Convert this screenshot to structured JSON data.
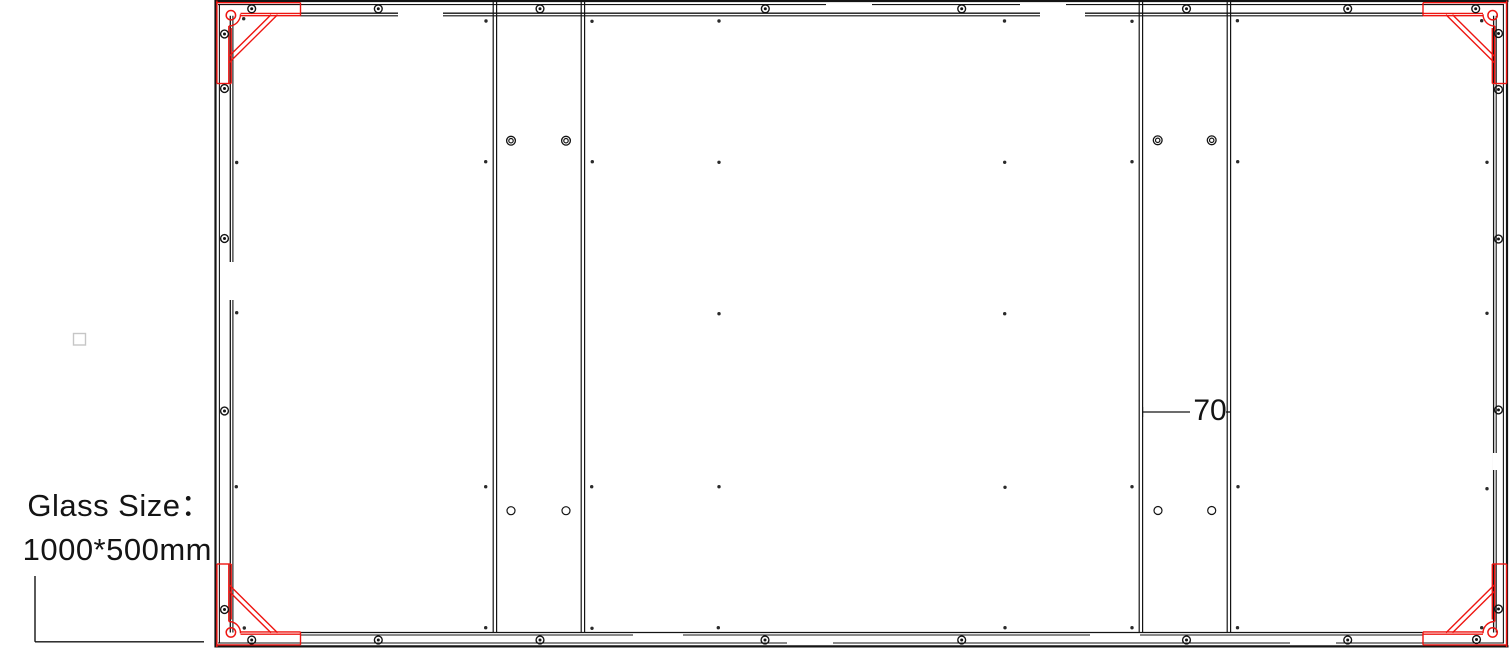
{
  "labels": {
    "glass_size_line1": "Glass Size：",
    "glass_size_line2": "1000*500mm",
    "bar_width_dimension": "70"
  },
  "colors": {
    "line": "#141414",
    "red": "#ee1511",
    "faint": "#c6c6c6",
    "background": "#ffffff"
  },
  "drawing": {
    "width": 1509,
    "height": 648,
    "black_lines": [
      [
        214.5,
        1,
        1508.5,
        1,
        2.2
      ],
      [
        218,
        4.6,
        1504,
        4.6,
        1.1
      ],
      [
        214.5,
        646.4,
        1508.5,
        646.4,
        2.2
      ],
      [
        218,
        643,
        1504,
        643,
        1.1
      ],
      [
        215.5,
        0,
        215.5,
        647.5,
        2.2
      ],
      [
        219.4,
        4,
        219.4,
        643.5,
        1.1
      ],
      [
        1507,
        0,
        1507,
        647.5,
        2.2
      ],
      [
        1503.4,
        4,
        1503.4,
        643.5,
        1.1
      ],
      [
        300.5,
        13.2,
        1423,
        13.2,
        1.3
      ],
      [
        300.5,
        15.8,
        1423,
        15.8,
        1.1
      ],
      [
        300.5,
        632.5,
        1423,
        632.5,
        1.3
      ],
      [
        300.5,
        635,
        1423,
        635,
        1.1
      ],
      [
        230.3,
        15.8,
        230.3,
        632.5,
        1.3
      ],
      [
        232.9,
        15.8,
        232.9,
        632.5,
        1.1
      ],
      [
        1493.6,
        15.8,
        1493.6,
        632.5,
        1.3
      ],
      [
        1496.2,
        15.8,
        1496.2,
        632.5,
        1.1
      ],
      [
        493.2,
        1,
        493.2,
        632.5,
        1.2
      ],
      [
        496.6,
        1,
        496.6,
        632.5,
        1.2
      ],
      [
        581.2,
        1,
        581.2,
        632.5,
        1.2
      ],
      [
        584.6,
        1,
        584.6,
        632.5,
        1.2
      ],
      [
        1139.2,
        1,
        1139.2,
        632.5,
        1.2
      ],
      [
        1142.6,
        1,
        1142.6,
        632.5,
        1.2
      ],
      [
        1227.2,
        1,
        1227.2,
        632.5,
        1.2
      ],
      [
        1230.6,
        1,
        1230.6,
        632.5,
        1.2
      ],
      [
        1142.6,
        412,
        1190,
        412,
        1.3
      ],
      [
        1226,
        412,
        1230.6,
        412,
        1.3
      ],
      [
        1142.6,
        407,
        1142.6,
        417,
        1.1
      ],
      [
        35,
        576,
        35,
        641.8,
        1.4
      ],
      [
        35,
        641.8,
        204,
        641.8,
        1.4
      ]
    ],
    "white_gaps": [
      [
        398,
        12.4,
        45,
        4.2
      ],
      [
        1040,
        12.4,
        45,
        4.2
      ],
      [
        826,
        3.8,
        46,
        1.8
      ],
      [
        1020,
        3.8,
        46,
        1.8
      ],
      [
        633,
        634.2,
        50,
        1.7
      ],
      [
        1090,
        634.2,
        50,
        1.7
      ],
      [
        787,
        642.2,
        46,
        1.7
      ],
      [
        1290,
        642.2,
        46,
        1.7
      ],
      [
        229.4,
        262,
        4.6,
        38
      ],
      [
        1492.7,
        453,
        4.7,
        17
      ]
    ],
    "red_lines": [
      [
        216,
        2.7,
        300.5,
        2.7
      ],
      [
        240.5,
        13.4,
        300.5,
        13.4
      ],
      [
        240.5,
        15.7,
        300.5,
        15.7
      ],
      [
        300.5,
        2.7,
        300.5,
        15.7
      ],
      [
        216.9,
        0.5,
        216.9,
        83.5
      ],
      [
        228.8,
        26,
        228.8,
        83.5
      ],
      [
        231.2,
        28,
        231.2,
        83.5
      ],
      [
        216.9,
        83.5,
        231.2,
        83.5
      ],
      [
        271,
        14.8,
        229.3,
        56
      ],
      [
        277.5,
        14.8,
        229.3,
        62.5
      ],
      [
        1423,
        2.7,
        1507.5,
        2.7
      ],
      [
        1423,
        13.4,
        1483,
        13.4
      ],
      [
        1423,
        15.7,
        1483,
        15.7
      ],
      [
        1423,
        2.7,
        1423,
        15.7
      ],
      [
        1506.6,
        0.5,
        1506.6,
        83.5
      ],
      [
        1494.7,
        26,
        1494.7,
        83.5
      ],
      [
        1492.3,
        28,
        1492.3,
        83.5
      ],
      [
        1492.3,
        83.5,
        1506.6,
        83.5
      ],
      [
        1452.5,
        14.8,
        1494.2,
        56
      ],
      [
        1446,
        14.8,
        1494.2,
        62.5
      ],
      [
        216,
        644.9,
        300.5,
        644.9
      ],
      [
        240.5,
        634.2,
        300.5,
        634.2
      ],
      [
        240.5,
        631.9,
        300.5,
        631.9
      ],
      [
        300.5,
        631.9,
        300.5,
        644.9
      ],
      [
        216.9,
        564,
        216.9,
        647
      ],
      [
        228.8,
        564,
        228.8,
        621.5
      ],
      [
        231.2,
        564,
        231.2,
        619.5
      ],
      [
        216.9,
        564,
        231.2,
        564
      ],
      [
        271,
        632.8,
        229.3,
        591.5
      ],
      [
        277.5,
        632.8,
        229.3,
        585
      ],
      [
        1423,
        644.9,
        1507.5,
        644.9
      ],
      [
        1423,
        634.2,
        1483,
        634.2
      ],
      [
        1423,
        631.9,
        1483,
        631.9
      ],
      [
        1423,
        631.9,
        1423,
        644.9
      ],
      [
        1506.6,
        564,
        1506.6,
        647
      ],
      [
        1494.7,
        564,
        1494.7,
        621.5
      ],
      [
        1492.3,
        564,
        1492.3,
        619.5
      ],
      [
        1492.3,
        564,
        1506.6,
        564
      ],
      [
        1452.5,
        632.8,
        1494.2,
        591.5
      ],
      [
        1446,
        632.8,
        1494.2,
        585
      ]
    ],
    "red_arcs": [
      "M 228.8 26 A 11.7 11.7 0 0 0 240.5 14.3",
      "M 1494.7 26 A 11.7 11.7 0 0 1 1483 14.3",
      "M 228.8 621.5 A 11.7 11.7 0 0 1 240.5 633.2",
      "M 1494.7 621.5 A 11.7 11.7 0 0 0 1483 633.2"
    ],
    "red_circles": [
      [
        230.9,
        15.2,
        4.7
      ],
      [
        1492.6,
        15.2,
        4.7
      ],
      [
        230.9,
        632.4,
        4.7
      ],
      [
        1492.6,
        632.4,
        4.7
      ]
    ],
    "screws": [
      [
        251.7,
        8.8
      ],
      [
        378.3,
        8.8
      ],
      [
        540,
        8.8
      ],
      [
        765.3,
        8.8
      ],
      [
        961.7,
        8.8
      ],
      [
        1186.5,
        8.8
      ],
      [
        1347.7,
        8.8
      ],
      [
        1475.7,
        8.8
      ],
      [
        251.7,
        640
      ],
      [
        378.3,
        640
      ],
      [
        540,
        640
      ],
      [
        765,
        640
      ],
      [
        961.7,
        640
      ],
      [
        1186.5,
        640
      ],
      [
        1347.7,
        640
      ],
      [
        1476.5,
        639.5
      ],
      [
        224.5,
        34
      ],
      [
        224.5,
        88.5
      ],
      [
        224.5,
        238.5
      ],
      [
        224.5,
        411
      ],
      [
        224.5,
        609.5
      ],
      [
        1498.5,
        33.5
      ],
      [
        1498.5,
        89.5
      ],
      [
        1498.5,
        239
      ],
      [
        1498.5,
        410
      ],
      [
        1498.5,
        609
      ]
    ],
    "grommets": [
      [
        511,
        140.7
      ],
      [
        566,
        140.7
      ],
      [
        1157.7,
        140.3
      ],
      [
        1211.7,
        140.3
      ]
    ],
    "rings": [
      [
        511,
        510.7
      ],
      [
        566,
        510.7
      ],
      [
        1158,
        510.5
      ],
      [
        1211.7,
        510.5
      ]
    ],
    "dots": [
      [
        486,
        21
      ],
      [
        592,
        21.3
      ],
      [
        719,
        21
      ],
      [
        1004.5,
        21
      ],
      [
        1132,
        21.3
      ],
      [
        1237.4,
        20.7
      ],
      [
        243.7,
        18.7
      ],
      [
        1481.7,
        20.7
      ],
      [
        244.3,
        628
      ],
      [
        1481.7,
        627.7
      ],
      [
        236.7,
        162.5
      ],
      [
        485.7,
        161.7
      ],
      [
        592.3,
        161.7
      ],
      [
        719,
        162.3
      ],
      [
        1004.7,
        162.3
      ],
      [
        1132,
        161.7
      ],
      [
        1237.7,
        161.7
      ],
      [
        1487,
        162.3
      ],
      [
        236.7,
        312.7
      ],
      [
        719,
        313.7
      ],
      [
        1004.7,
        313.7
      ],
      [
        1487,
        313.3
      ],
      [
        236.3,
        486.7
      ],
      [
        485.7,
        486.7
      ],
      [
        591.7,
        486.7
      ],
      [
        719,
        486.7
      ],
      [
        1005,
        487.3
      ],
      [
        1132,
        486.7
      ],
      [
        1238,
        486.7
      ],
      [
        1487,
        488.7
      ],
      [
        485.7,
        627.7
      ],
      [
        592,
        628.3
      ],
      [
        718.3,
        627.7
      ],
      [
        1005,
        627.7
      ],
      [
        1132,
        627.7
      ],
      [
        1237.5,
        627.7
      ]
    ],
    "faint_square": {
      "x": 73.5,
      "y": 333.5,
      "w": 12,
      "h": 11.5
    }
  }
}
